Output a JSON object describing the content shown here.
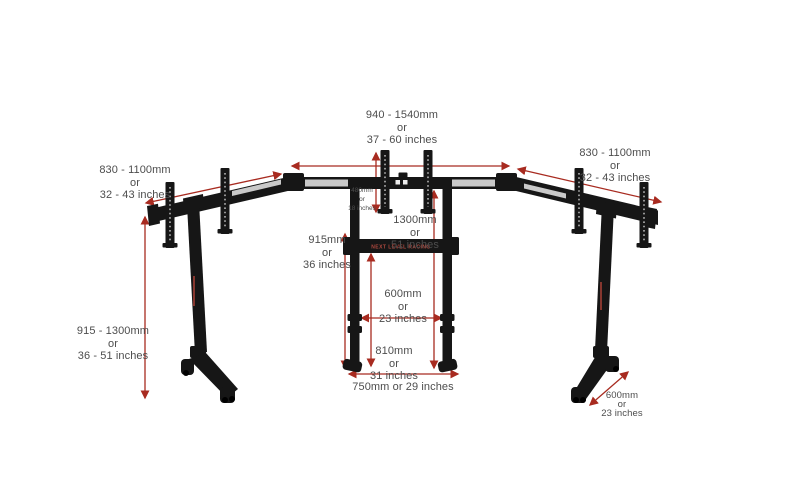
{
  "colors": {
    "background": "#ffffff",
    "stand_black": "#161616",
    "silver": "#c9c9c9",
    "dimension_red": "#a82b20",
    "label_gray": "#4d4d4d"
  },
  "branding": {
    "crossbar": "NEXT LEVEL RACING"
  },
  "labels": {
    "monitor_span": {
      "mm": "940 - 1540mm",
      "or": "or",
      "inches": "37 - 60 inches"
    },
    "left_arm": {
      "mm": "830 - 1100mm",
      "or": "or",
      "inches": "32 - 43 inches"
    },
    "right_arm": {
      "mm": "830 - 1100mm",
      "or": "or",
      "inches": "32 - 43 inches"
    },
    "stand_height": {
      "mm": "915 - 1300mm",
      "or": "or",
      "inches": "36 - 51 inches"
    },
    "bracket_height": {
      "mm": "480mm",
      "or": "or",
      "inches": "18 inches"
    },
    "frame_height": {
      "mm": "1300mm",
      "or": "or",
      "inches": "51 inches"
    },
    "mid_height": {
      "mm": "915mm",
      "or": "or",
      "inches": "36 inches"
    },
    "lower_height": {
      "mm": "810mm",
      "or": "or",
      "inches": "31 inches"
    },
    "inner_width": {
      "mm": "600mm",
      "or": "or",
      "inches": "23 inches"
    },
    "feet_width": {
      "text": "750mm or 29 inches"
    },
    "foot_depth": {
      "mm": "600mm",
      "or": "or",
      "inches": "23 inches"
    }
  }
}
